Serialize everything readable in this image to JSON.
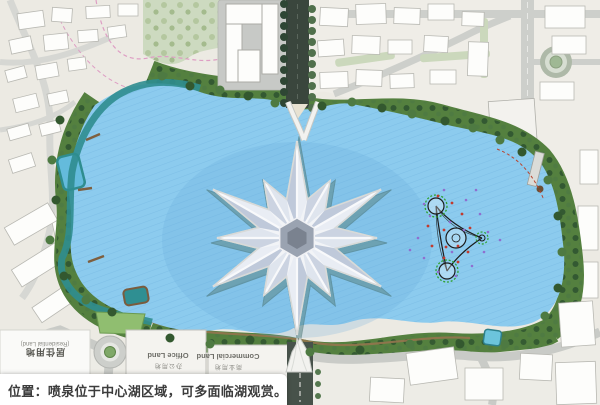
{
  "caption": {
    "text": "位置：喷泉位于中心湖区域，可多面临湖观赏。"
  },
  "parcels": {
    "residential": {
      "zh": "居住用地",
      "en": "(Residential Land)"
    },
    "office": {
      "zh": "办公用地",
      "en": "Office Land"
    },
    "commercial": {
      "zh": "商业用地",
      "en": "Commercial Land"
    }
  },
  "colors": {
    "lake": "#8CCBEE",
    "lake_hatch": "#6FB4E0",
    "shore_green": "#54803F",
    "teal_edge": "#2F8D8F",
    "sage_park": "#CDDAC0",
    "road": "#C9CBC7",
    "road_dark": "#47524A",
    "urban": "#ECEAE3",
    "plaza": "#C7C9C6",
    "building": "#FDFDFB",
    "star_glass_dark": "#BFC9DA",
    "star_glass_light": "#E9EDF4",
    "fountain_ring_green": "#2FA12F",
    "dot_red": "#C23B2E",
    "dot_purple": "#8F6FD0",
    "pink_dash": "#DE9EC4",
    "caption_text": "#3C3C3C"
  }
}
